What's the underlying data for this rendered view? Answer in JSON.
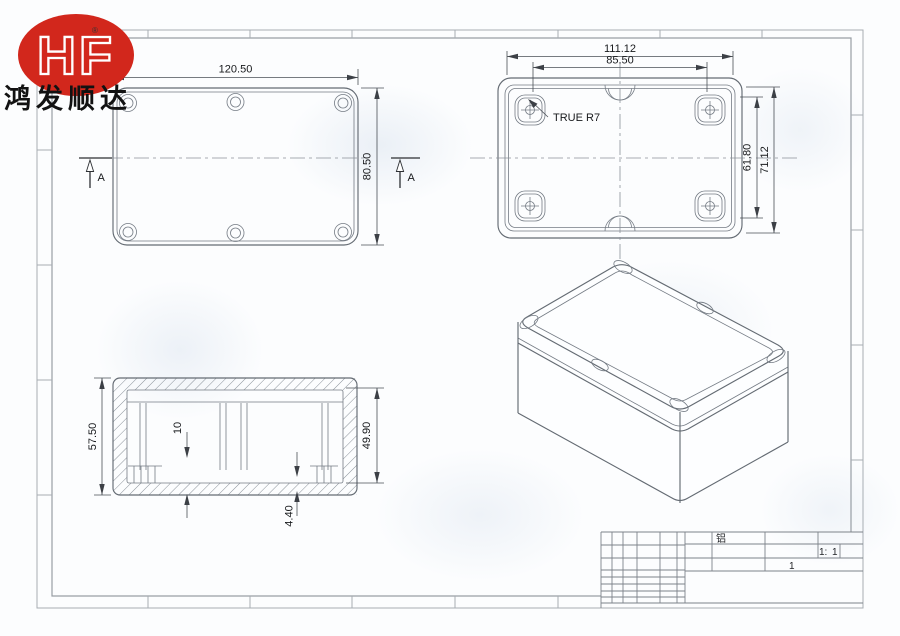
{
  "brand": {
    "logo_text": "HF",
    "registered_mark": "®",
    "company_name": "鸿发顺达",
    "logo_color": "#d2271c"
  },
  "views": {
    "lid_plan": {
      "dim_width": "120.50",
      "dim_height": "80.50",
      "section_label": "A"
    },
    "base_plan": {
      "dim_outer_width": "111.12",
      "dim_boss_spacing": "85.50",
      "dim_inner_height": "61.80",
      "dim_outer_height": "71.12",
      "radius_note": "TRUE R7"
    },
    "section": {
      "dim_overall_height": "57.50",
      "dim_inner_depth": "49.90",
      "dim_boss_offset": "10",
      "dim_base_thickness": "4.40"
    }
  },
  "title_block": {
    "material": "铝",
    "scale_prefix": "1:",
    "scale_value": "1",
    "sheet_number": "1"
  },
  "colors": {
    "line": "#646b73",
    "dimension": "#3c4046",
    "text": "#17191c",
    "frame": "#9aa0a6",
    "logo_red": "#d2271c"
  }
}
